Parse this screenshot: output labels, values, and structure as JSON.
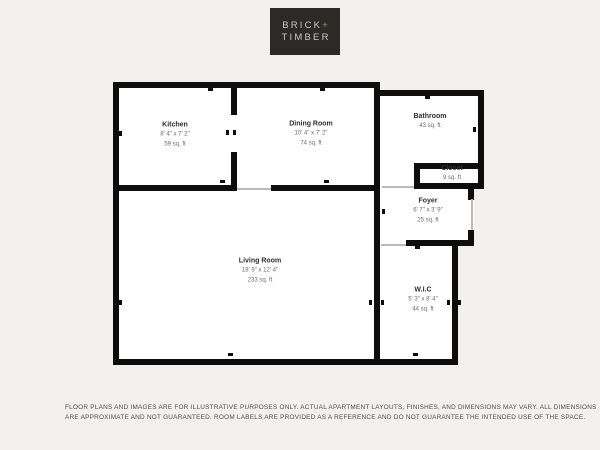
{
  "page": {
    "background": "#f2f1ee"
  },
  "logo": {
    "line1": "BRICK",
    "plus": "+",
    "line2": "TIMBER",
    "box_color": "#2b2a27",
    "text_color": "#ccc7c0",
    "plus_color": "#b1886a"
  },
  "floorplan": {
    "wall_color": "#0d0d0d",
    "floor_color": "#ffffff",
    "rooms": [
      {
        "id": "kitchen",
        "name": "Kitchen",
        "dims": "8' 4\" x 7' 2\"",
        "area": "59 sq. ft",
        "x": 175,
        "y": 135
      },
      {
        "id": "dining-room",
        "name": "Dining Room",
        "dims": "10' 4\" x 7' 2\"",
        "area": "74 sq. ft",
        "x": 311,
        "y": 134
      },
      {
        "id": "bathroom",
        "name": "Bathroom",
        "dims": "",
        "area": "43 sq. ft",
        "x": 430,
        "y": 122
      },
      {
        "id": "closet",
        "name": "Closet",
        "dims": "",
        "area": "9 sq. ft",
        "x": 452,
        "y": 174
      },
      {
        "id": "foyer",
        "name": "Foyer",
        "dims": "6' 7\" x 3' 9\"",
        "area": "25 sq. ft",
        "x": 428,
        "y": 211
      },
      {
        "id": "living-room",
        "name": "Living Room",
        "dims": "18' 9\" x 12' 4\"",
        "area": "233 sq. ft",
        "x": 260,
        "y": 271
      },
      {
        "id": "wic",
        "name": "W.I.C",
        "dims": "5' 3\" x 8' 4\"",
        "area": "44 sq. ft",
        "x": 423,
        "y": 300
      }
    ],
    "geometry": {
      "blocks": [
        [
          113,
          82,
          267,
          283
        ],
        [
          380,
          90,
          104,
          98
        ],
        [
          380,
          186,
          94,
          57
        ],
        [
          380,
          243,
          78,
          122
        ]
      ],
      "walls": [
        [
          113,
          82,
          267,
          6
        ],
        [
          113,
          82,
          6,
          283
        ],
        [
          113,
          359,
          267,
          6
        ],
        [
          374,
          82,
          6,
          283
        ],
        [
          231,
          82,
          6,
          33
        ],
        [
          231,
          152,
          6,
          39
        ],
        [
          113,
          185,
          124,
          6
        ],
        [
          271,
          185,
          109,
          6
        ],
        [
          380,
          90,
          104,
          6
        ],
        [
          478,
          90,
          6,
          99
        ],
        [
          414,
          163,
          70,
          6
        ],
        [
          414,
          163,
          6,
          26
        ],
        [
          414,
          183,
          70,
          6
        ],
        [
          468,
          189,
          6,
          11
        ],
        [
          468,
          230,
          6,
          16
        ],
        [
          406,
          240,
          68,
          6
        ],
        [
          452,
          246,
          6,
          119
        ],
        [
          374,
          359,
          84,
          6
        ]
      ],
      "thin_lines": [
        [
          237,
          188,
          34,
          2
        ],
        [
          382,
          186,
          32,
          2
        ],
        [
          471,
          199,
          2,
          31
        ],
        [
          381,
          244,
          25,
          2
        ]
      ],
      "ticks": [
        [
          208,
          88,
          5,
          3
        ],
        [
          320,
          88,
          5,
          3
        ],
        [
          119,
          131,
          3,
          5
        ],
        [
          119,
          300,
          3,
          5
        ],
        [
          220,
          180,
          5,
          3
        ],
        [
          324,
          180,
          5,
          3
        ],
        [
          228,
          353,
          5,
          3
        ],
        [
          226,
          130,
          3,
          5
        ],
        [
          233,
          130,
          3,
          5
        ],
        [
          369,
          300,
          3,
          5
        ],
        [
          381,
          300,
          3,
          5
        ],
        [
          447,
          300,
          3,
          5
        ],
        [
          458,
          300,
          3,
          5
        ],
        [
          425,
          96,
          5,
          3
        ],
        [
          473,
          127,
          3,
          5
        ],
        [
          415,
          246,
          5,
          3
        ],
        [
          413,
          353,
          5,
          3
        ],
        [
          382,
          209,
          3,
          5
        ]
      ]
    }
  },
  "disclaimer": {
    "line1": "FLOOR PLANS AND IMAGES ARE FOR ILLUSTRATIVE PURPOSES ONLY. ACTUAL APARTMENT LAYOUTS, FINISHES, AND DIMENSIONS MAY VARY. ALL DIMENSIONS",
    "line2": "ARE APPROXIMATE AND NOT GUARANTEED. ROOM LABELS ARE PROVIDED AS A REFERENCE AND DO NOT GUARANTEE THE INTENDED USE OF THE SPACE."
  }
}
